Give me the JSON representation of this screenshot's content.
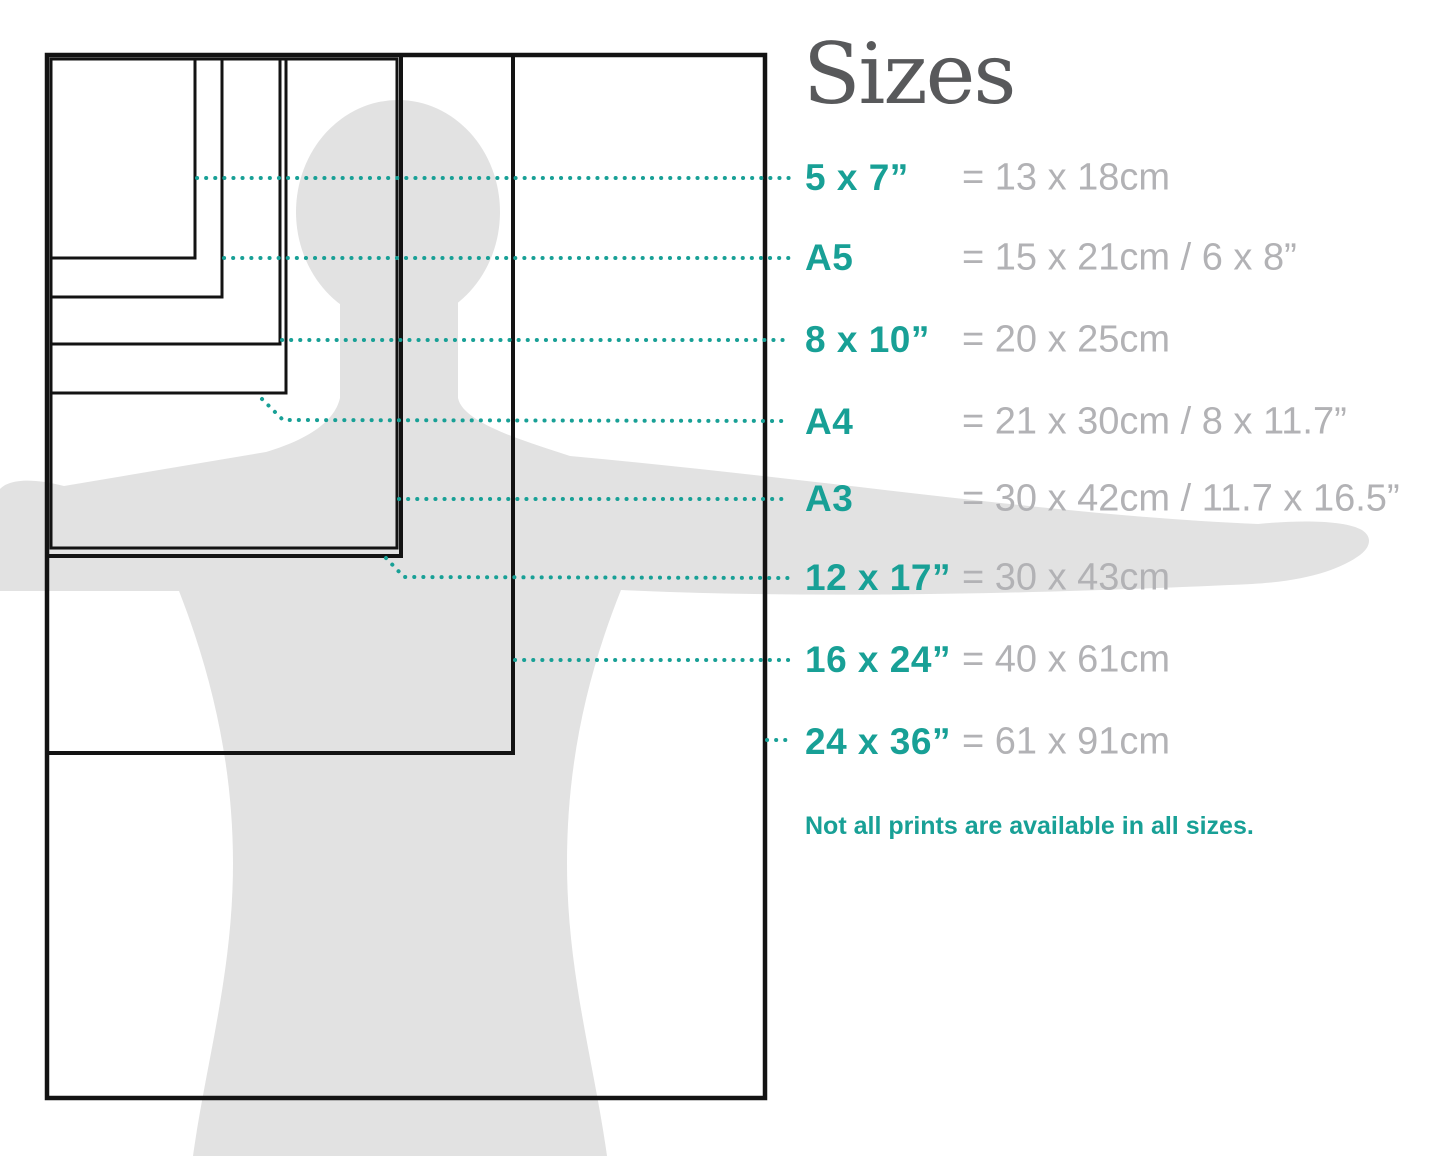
{
  "title": "Sizes",
  "note": "Not all prints are available in all sizes.",
  "rows": [
    {
      "label": "5 x 7”",
      "value": "= 13 x 18cm"
    },
    {
      "label": "A5",
      "value": "= 15 x 21cm / 6 x 8”"
    },
    {
      "label": "8 x 10”",
      "value": "= 20 x 25cm"
    },
    {
      "label": "A4",
      "value": "= 21 x 30cm / 8 x 11.7”"
    },
    {
      "label": "A3",
      "value": "= 30 x 42cm / 11.7 x 16.5”"
    },
    {
      "label": "12 x 17”",
      "value": "= 30 x 43cm"
    },
    {
      "label": "16 x 24”",
      "value": "= 40 x 61cm"
    },
    {
      "label": "24 x 36”",
      "value": "= 61 x 91cm"
    }
  ],
  "diagram": {
    "silhouette": "person-silhouette-arms-outstretched",
    "rect_sizes": [
      "5 x 7”",
      "A5",
      "8 x 10”",
      "A4",
      "A3",
      "12 x 17”",
      "16 x 24”",
      "24 x 36”"
    ]
  },
  "colors": {
    "accent_teal": "#18A096",
    "value_gray": "#B2B2B5",
    "title_gray": "#58595B",
    "silhouette_gray": "#E2E2E2",
    "outline_black": "#131313",
    "background": "#FFFFFF"
  }
}
